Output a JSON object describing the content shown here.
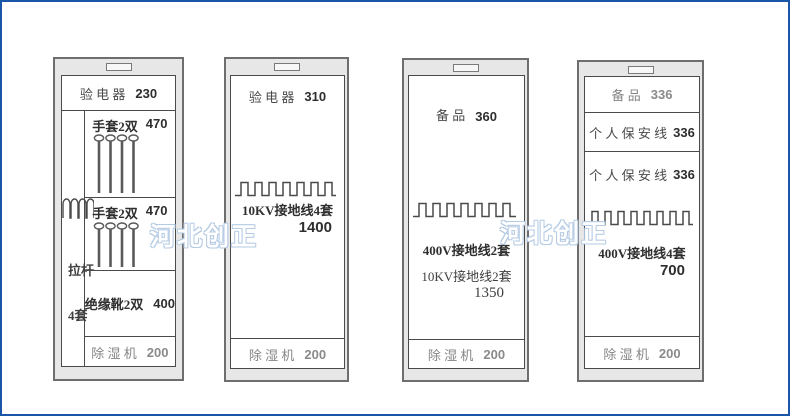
{
  "watermark": {
    "text": "河北创正",
    "color": "#b5cbe4"
  },
  "cabinets": [
    {
      "top": {
        "label": "验 电 器",
        "value": "230"
      },
      "rods": {
        "line1": "拉杆",
        "line2": "4套"
      },
      "glove1": {
        "label": "手套2双",
        "value": "470"
      },
      "glove2": {
        "label": "手套2双",
        "value": "470"
      },
      "boots": {
        "label": "绝缘靴2双",
        "value": "400"
      },
      "dehumidifier": {
        "label": "除 湿 机",
        "value": "200"
      }
    },
    {
      "top": {
        "label": "验 电 器",
        "value": "310"
      },
      "middle": {
        "line1": "10KV接地线4套",
        "line2": "1400"
      },
      "dehumidifier": {
        "label": "除 湿 机",
        "value": "200"
      }
    },
    {
      "top": {
        "label": "备 品",
        "value": "360"
      },
      "middle": {
        "line1": "400V接地线2套",
        "line2": "10KV接地线2套",
        "line3": "1350"
      },
      "dehumidifier": {
        "label": "除 湿 机",
        "value": "200"
      }
    },
    {
      "top": {
        "label": "备 品",
        "value": "336"
      },
      "wire1": {
        "label": "个 人 保 安 线",
        "value": "336"
      },
      "wire2": {
        "label": "个 人 保 安 线",
        "value": "336"
      },
      "middle": {
        "line1": "400V接地线4套",
        "line2": "700"
      },
      "dehumidifier": {
        "label": "除 湿 机",
        "value": "200"
      }
    }
  ]
}
